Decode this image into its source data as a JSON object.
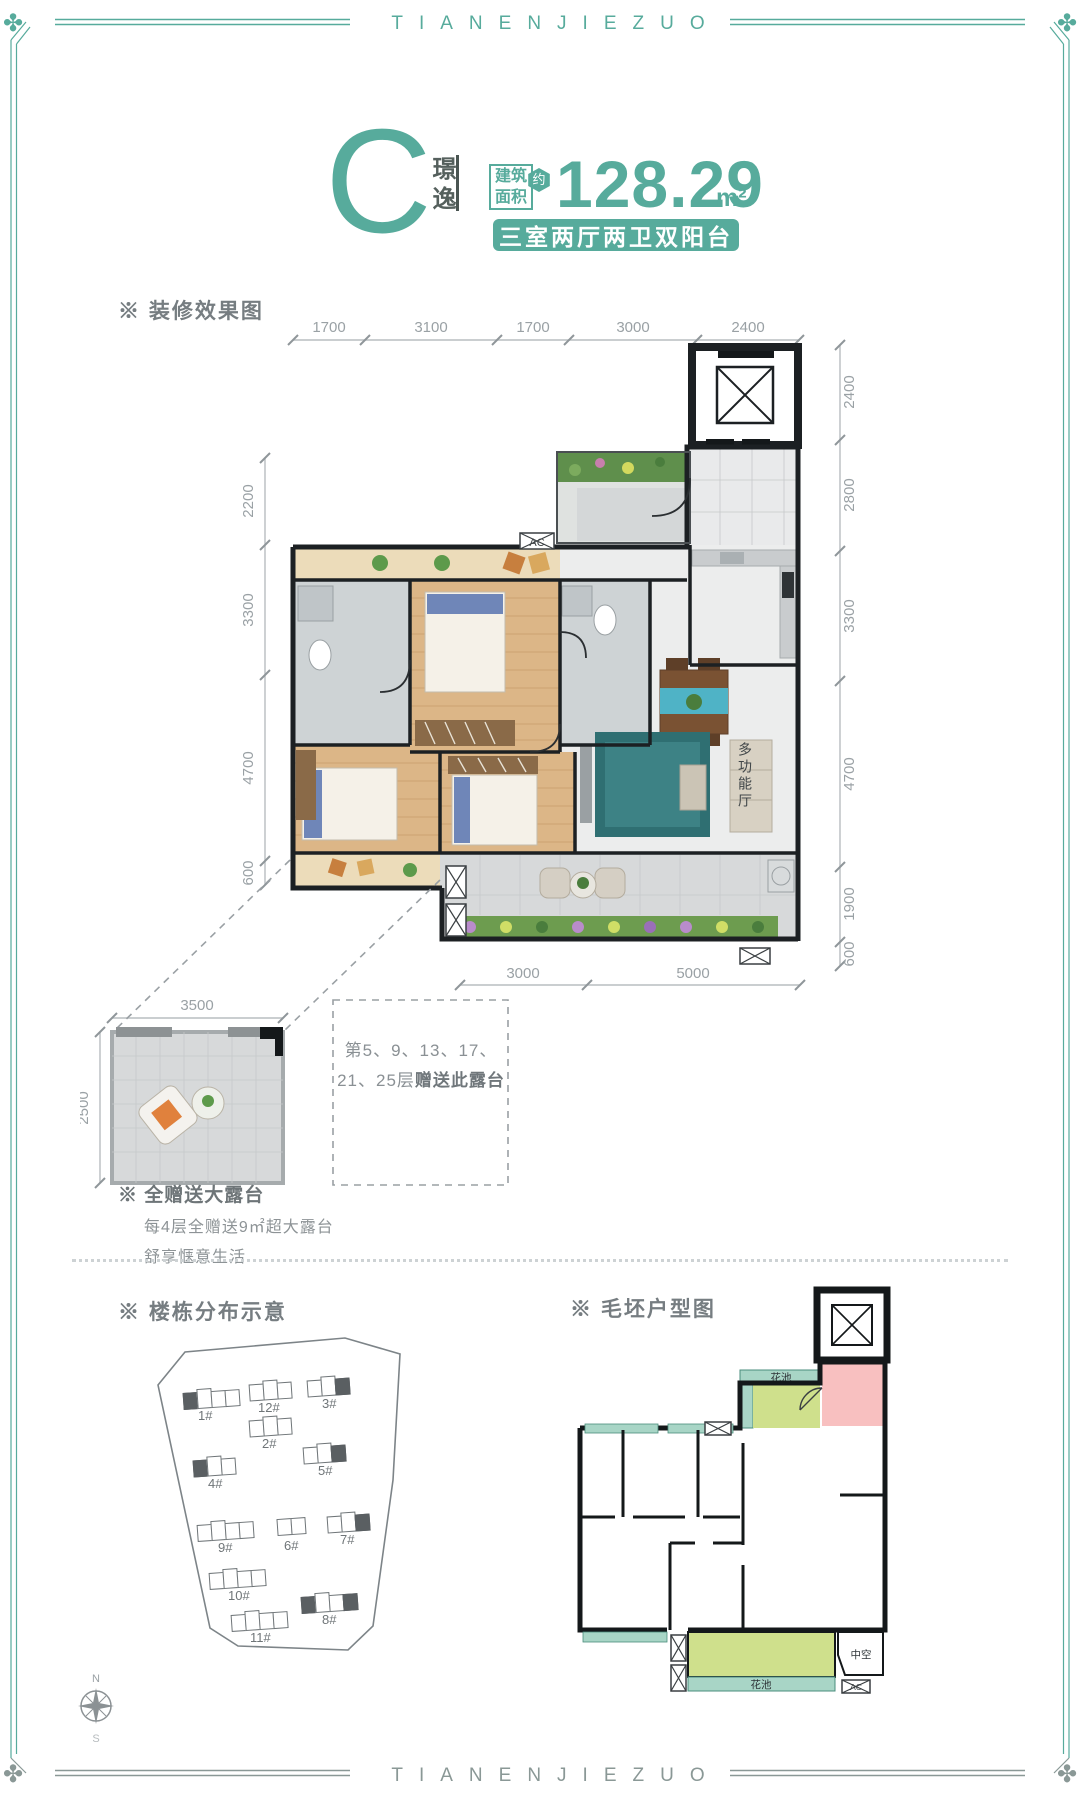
{
  "brand": {
    "top_banner": "TIANENJIEZUO",
    "bottom_banner": "TIANENJIEZUO",
    "accent_color": "#57ab9c",
    "frame_gray": "#8a9896"
  },
  "header": {
    "unit_letter": "C",
    "unit_name": "璟逸",
    "area_label_top": "建筑",
    "area_label_bottom": "面积",
    "approx_badge": "约",
    "area_value": "128.29",
    "area_unit": "m²",
    "layout_badge": "三室两厅两卫双阳台"
  },
  "section_labels": {
    "decorated_plan": "※ 装修效果图",
    "site_plan": "※ 楼栋分布示意",
    "bare_plan": "※ 毛坯户型图"
  },
  "main_plan": {
    "dims_top": [
      "1700",
      "3100",
      "1700",
      "3000",
      "2400"
    ],
    "dims_right": [
      "2400",
      "2800",
      "3300",
      "4700",
      "1900",
      "600"
    ],
    "dims_left": [
      "2200",
      "3300",
      "4700",
      "600"
    ],
    "dims_bottom": [
      "3000",
      "5000"
    ],
    "multifunction_room_label": "多功能厅",
    "ac_label": "AC"
  },
  "terrace_detail": {
    "dim_top": "3500",
    "dim_left": "2500",
    "floors_note_line1": "第5、9、13、17、",
    "floors_note_line2_normal": "21、25层",
    "floors_note_line2_bold": "赠送此露台"
  },
  "terrace_gift": {
    "title": "※ 全赠送大露台",
    "line1": "每4层全赠送9㎡超大露台",
    "line2": "舒享惬意生活"
  },
  "site_plan": {
    "buildings": [
      "1#",
      "12#",
      "3#",
      "2#",
      "4#",
      "5#",
      "9#",
      "6#",
      "7#",
      "10#",
      "8#",
      "11#"
    ]
  },
  "bare_plan": {
    "flower_bed_top": "花池",
    "flower_bed_bottom": "花池",
    "void_label": "中空",
    "ac_label": "AC"
  },
  "compass": {
    "north": "N",
    "south": "S"
  }
}
